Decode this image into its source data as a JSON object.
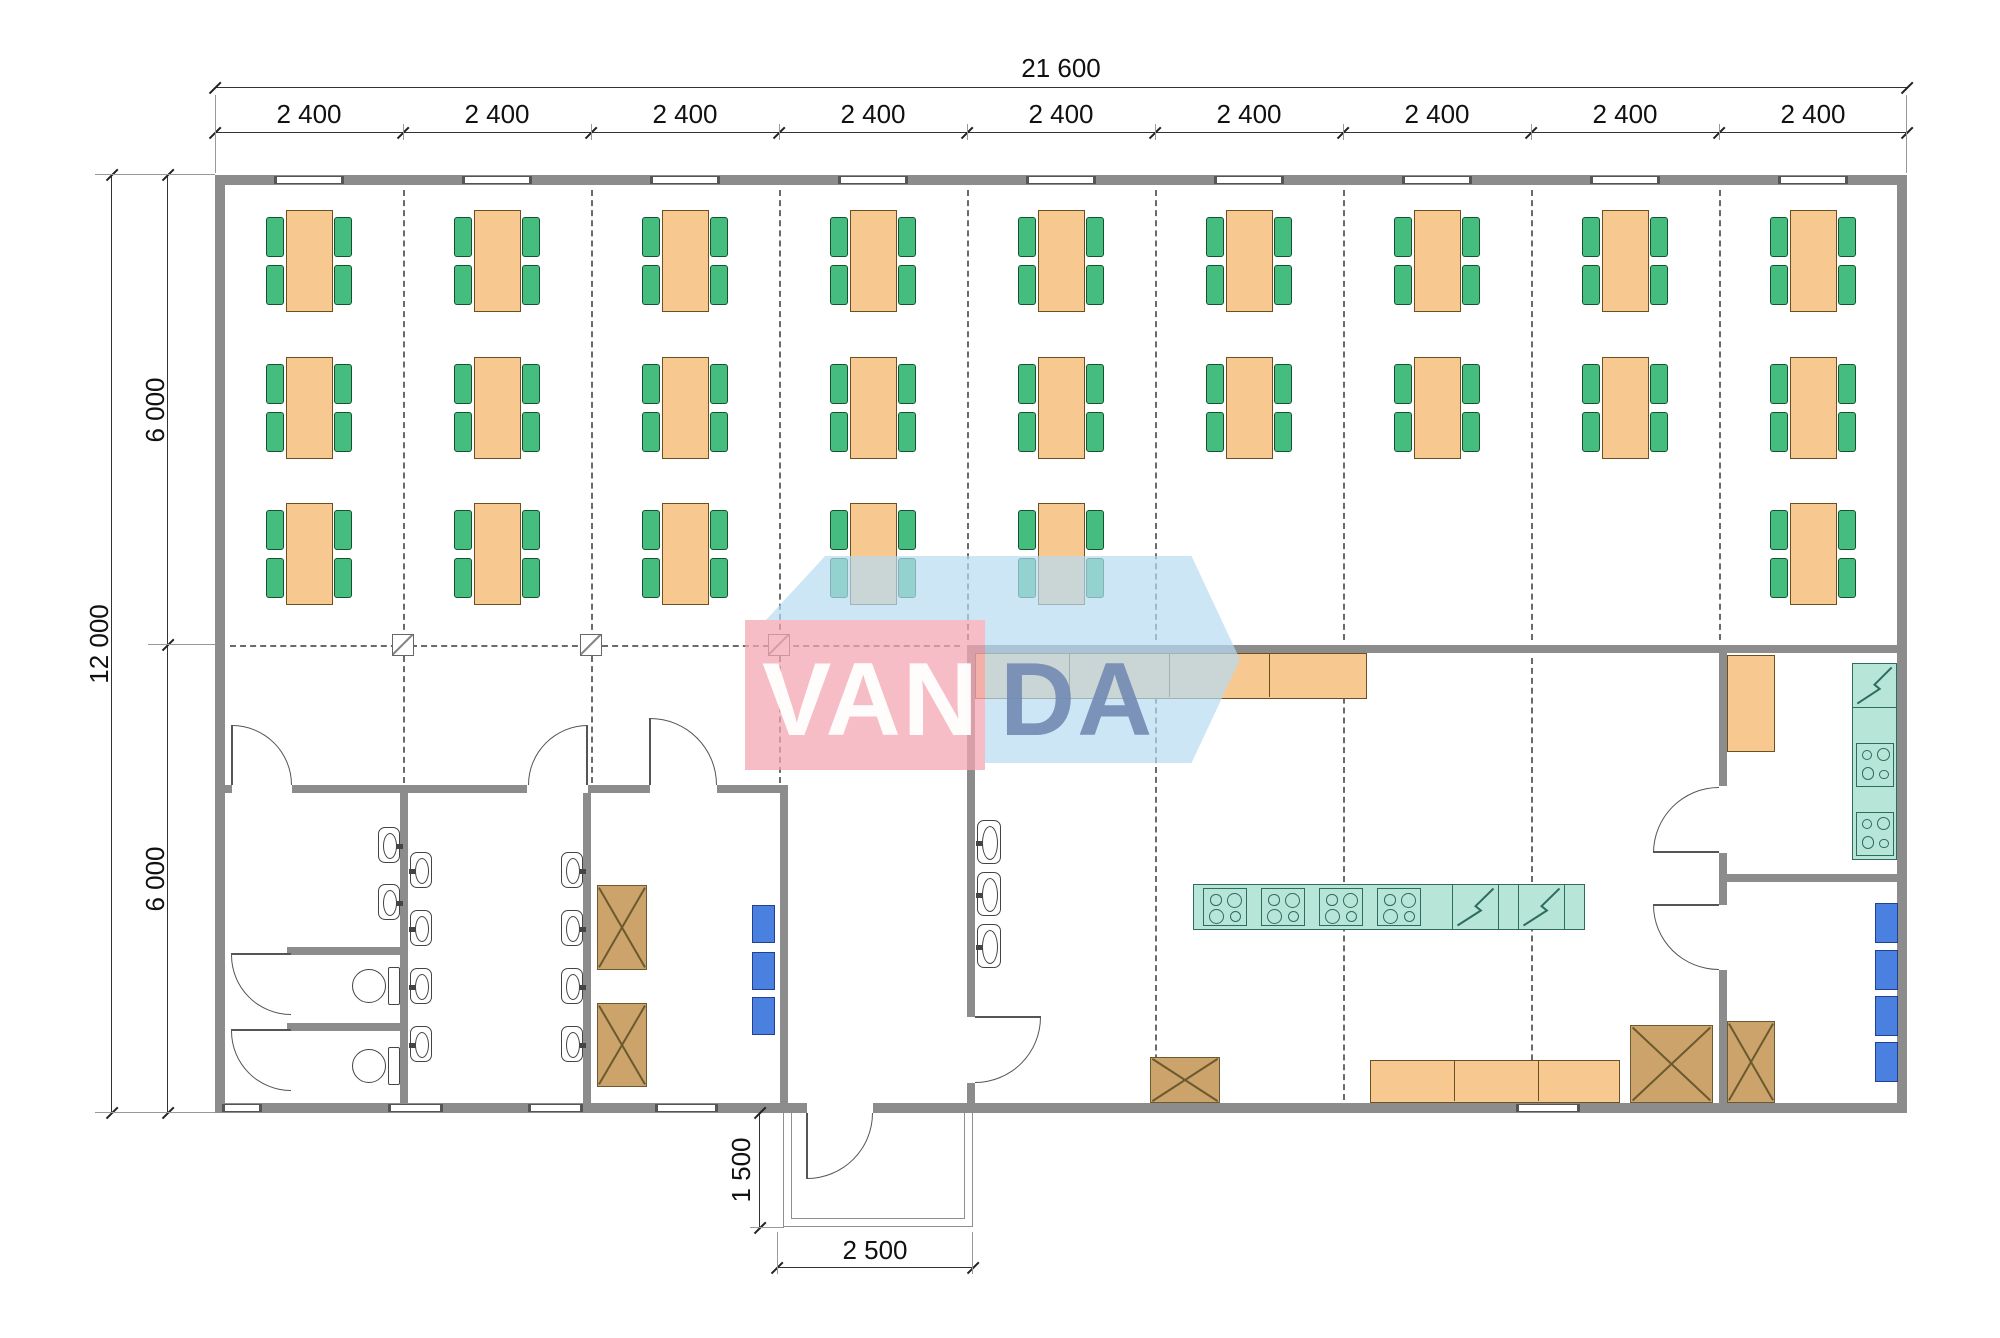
{
  "dimensions": {
    "top_total": "21 600",
    "bays": [
      "2 400",
      "2 400",
      "2 400",
      "2 400",
      "2 400",
      "2 400",
      "2 400",
      "2 400",
      "2 400"
    ],
    "left_total": "12 000",
    "left_halves": [
      "6 000",
      "6 000"
    ],
    "porch_depth": "1 500",
    "porch_width": "2 500"
  },
  "watermark": {
    "text_left": "VAN",
    "text_right": "DA",
    "pink": "#f4a6b2",
    "blue": "#b7dbf2",
    "da_color": "#7088b0"
  },
  "colors": {
    "wall": "#8c8c8c",
    "table": "#f7c890",
    "chair": "#45bd7e",
    "equipment_teal": "#b7e6d9",
    "locker_blue": "#4a80e0",
    "cabinet_brown": "#cba36b",
    "counter_orange": "#f7c890"
  },
  "plan": {
    "walls": [
      [
        215,
        175,
        1692,
        10
      ],
      [
        215,
        1103,
        592,
        10
      ],
      [
        873,
        1103,
        1034,
        10
      ],
      [
        215,
        175,
        10,
        938
      ],
      [
        1897,
        175,
        10,
        938
      ],
      [
        225,
        785,
        7,
        8
      ],
      [
        292,
        785,
        235,
        8
      ],
      [
        588,
        785,
        62,
        8
      ],
      [
        717,
        785,
        71,
        8
      ],
      [
        400,
        793,
        8,
        310
      ],
      [
        583,
        793,
        8,
        310
      ],
      [
        780,
        793,
        8,
        310
      ],
      [
        967,
        645,
        8,
        372
      ],
      [
        967,
        1083,
        8,
        20
      ],
      [
        975,
        645,
        922,
        8
      ],
      [
        287,
        947,
        113,
        8
      ],
      [
        287,
        1023,
        113,
        8
      ],
      [
        1727,
        874,
        170,
        8
      ],
      [
        1719,
        653,
        8,
        133
      ],
      [
        1719,
        853,
        8,
        52
      ],
      [
        1719,
        970,
        8,
        133
      ]
    ],
    "windows_top": [
      [
        274,
        70
      ],
      [
        462,
        70
      ],
      [
        650,
        70
      ],
      [
        838,
        70
      ],
      [
        1026,
        70
      ],
      [
        1214,
        70
      ],
      [
        1402,
        70
      ],
      [
        1590,
        70
      ],
      [
        1778,
        70
      ]
    ],
    "windows_bottom": [
      [
        222,
        40
      ],
      [
        388,
        55
      ],
      [
        528,
        55
      ],
      [
        655,
        63
      ],
      [
        1516,
        64
      ]
    ],
    "grid_v": [
      [
        403,
        190,
        640
      ],
      [
        591,
        190,
        640
      ],
      [
        779,
        190,
        640
      ],
      [
        967,
        190,
        640
      ],
      [
        1155,
        190,
        640
      ],
      [
        1343,
        190,
        640
      ],
      [
        1531,
        190,
        640
      ],
      [
        1719,
        190,
        640
      ],
      [
        403,
        656,
        783
      ],
      [
        591,
        656,
        783
      ],
      [
        779,
        656,
        783
      ],
      [
        1155,
        658,
        1100
      ],
      [
        1343,
        658,
        1100
      ],
      [
        1531,
        658,
        1100
      ]
    ],
    "grid_h": [
      [
        645,
        230,
        960
      ]
    ],
    "markers": [
      [
        392,
        634
      ],
      [
        580,
        634
      ],
      [
        768,
        634
      ]
    ],
    "bay_centers": [
      309,
      497,
      685,
      873,
      1061,
      1249,
      1437,
      1625,
      1813
    ],
    "table_rows": [
      {
        "y": 210,
        "bays": [
          0,
          1,
          2,
          3,
          4,
          5,
          6,
          7,
          8
        ]
      },
      {
        "y": 357,
        "bays": [
          0,
          1,
          2,
          3,
          4,
          5,
          6,
          7,
          8
        ]
      },
      {
        "y": 503,
        "bays": [
          0,
          1,
          2,
          3,
          4,
          8
        ]
      }
    ],
    "basins": [
      [
        378,
        827,
        22,
        36,
        "e"
      ],
      [
        378,
        884,
        22,
        36,
        "e"
      ],
      [
        410,
        852,
        22,
        36,
        "w"
      ],
      [
        410,
        910,
        22,
        36,
        "w"
      ],
      [
        410,
        968,
        22,
        36,
        "w"
      ],
      [
        410,
        1026,
        22,
        36,
        "w"
      ],
      [
        561,
        852,
        22,
        36,
        "e"
      ],
      [
        561,
        910,
        22,
        36,
        "e"
      ],
      [
        561,
        968,
        22,
        36,
        "e"
      ],
      [
        561,
        1026,
        22,
        36,
        "e"
      ],
      [
        977,
        820,
        24,
        44,
        "w"
      ],
      [
        977,
        872,
        24,
        44,
        "w"
      ],
      [
        977,
        924,
        24,
        44,
        "w"
      ]
    ],
    "toilets": [
      [
        352,
        966
      ],
      [
        352,
        1046
      ]
    ],
    "x_cabinets": [
      [
        597,
        885,
        50,
        85
      ],
      [
        597,
        1003,
        50,
        84
      ],
      [
        1150,
        1057,
        70,
        46
      ],
      [
        1630,
        1025,
        83,
        78
      ],
      [
        1727,
        1021,
        48,
        82
      ]
    ],
    "lockers": [
      [
        752,
        905,
        23,
        38
      ],
      [
        752,
        952,
        23,
        38
      ],
      [
        752,
        997,
        23,
        38
      ],
      [
        1875,
        903,
        23,
        40
      ],
      [
        1875,
        950,
        23,
        40
      ],
      [
        1875,
        996,
        23,
        40
      ],
      [
        1875,
        1042,
        23,
        40
      ]
    ],
    "counters": [
      {
        "x": 975,
        "y": 653,
        "w": 392,
        "h": 46,
        "divs": [
          93,
          193,
          293
        ],
        "name": "serving-counter"
      },
      {
        "x": 1370,
        "y": 1060,
        "w": 250,
        "h": 43,
        "divs": [
          83,
          167
        ],
        "name": "kitchen-counter"
      },
      {
        "x": 1727,
        "y": 655,
        "w": 48,
        "h": 97,
        "divs": [],
        "name": "kitchen-cabinet"
      }
    ],
    "teal_counters": [
      [
        1852,
        663,
        45,
        197
      ],
      [
        1193,
        884,
        392,
        46
      ]
    ],
    "stoves": [
      [
        1203,
        888,
        44,
        38
      ],
      [
        1261,
        888,
        44,
        38
      ],
      [
        1319,
        888,
        44,
        38
      ],
      [
        1377,
        888,
        44,
        38
      ],
      [
        1856,
        743,
        38,
        44
      ],
      [
        1856,
        812,
        38,
        44
      ]
    ],
    "diag_cells": [
      [
        1452,
        884,
        47,
        46
      ],
      [
        1518,
        884,
        47,
        46
      ],
      [
        1852,
        663,
        45,
        45
      ]
    ],
    "arcs": [
      [
        232,
        725,
        60,
        60,
        "tr"
      ],
      [
        528,
        725,
        60,
        60,
        "tl"
      ],
      [
        650,
        718,
        67,
        67,
        "tr"
      ],
      [
        975,
        1017,
        66,
        66,
        "br"
      ],
      [
        807,
        1113,
        66,
        66,
        "br"
      ],
      [
        1653,
        787,
        66,
        66,
        "tl"
      ],
      [
        1653,
        905,
        66,
        65,
        "bl"
      ],
      [
        231,
        955,
        60,
        60,
        "bl"
      ],
      [
        231,
        1031,
        60,
        60,
        "bl"
      ]
    ],
    "leaves": [
      [
        231,
        725,
        2,
        60
      ],
      [
        586,
        725,
        2,
        60
      ],
      [
        649,
        718,
        2,
        67
      ],
      [
        975,
        1016,
        66,
        2
      ],
      [
        806,
        1113,
        2,
        66
      ],
      [
        1653,
        851,
        66,
        2
      ],
      [
        1653,
        904,
        66,
        2
      ],
      [
        231,
        953,
        60,
        2
      ],
      [
        231,
        1029,
        60,
        2
      ]
    ],
    "porch": {
      "outer": [
        783,
        1113,
        190,
        114
      ],
      "inner": [
        791,
        1113,
        174,
        106
      ]
    },
    "dim_lines": [
      [
        215,
        87,
        1692,
        1
      ],
      [
        215,
        132,
        1692,
        1
      ],
      [
        111,
        175,
        1,
        938
      ],
      [
        167,
        175,
        1,
        938
      ],
      [
        759,
        1113,
        1,
        115
      ],
      [
        777,
        1267,
        196,
        1
      ]
    ],
    "ticks": [
      [
        215,
        88
      ],
      [
        1907,
        88
      ],
      [
        215,
        133
      ],
      [
        403,
        133
      ],
      [
        591,
        133
      ],
      [
        779,
        133
      ],
      [
        967,
        133
      ],
      [
        1155,
        133
      ],
      [
        1343,
        133
      ],
      [
        1531,
        133
      ],
      [
        1719,
        133
      ],
      [
        1907,
        133
      ],
      [
        112,
        175
      ],
      [
        112,
        1113
      ],
      [
        168,
        175
      ],
      [
        168,
        645
      ],
      [
        168,
        1113
      ],
      [
        760,
        1113
      ],
      [
        760,
        1228
      ],
      [
        777,
        1268
      ],
      [
        973,
        1268
      ]
    ],
    "exts": [
      [
        215,
        95,
        1,
        78
      ],
      [
        1906,
        95,
        1,
        78
      ],
      [
        95,
        174,
        120,
        1
      ],
      [
        95,
        1112,
        120,
        1
      ],
      [
        148,
        644,
        67,
        1
      ],
      [
        750,
        1227,
        34,
        1
      ],
      [
        777,
        1232,
        1,
        42
      ],
      [
        972,
        1232,
        1,
        42
      ],
      [
        403,
        124,
        1,
        16
      ],
      [
        591,
        124,
        1,
        16
      ],
      [
        779,
        124,
        1,
        16
      ],
      [
        967,
        124,
        1,
        16
      ],
      [
        1155,
        124,
        1,
        16
      ],
      [
        1343,
        124,
        1,
        16
      ],
      [
        1531,
        124,
        1,
        16
      ],
      [
        1719,
        124,
        1,
        16
      ]
    ],
    "bay_label_y": 101,
    "labels": [
      {
        "x": 1011,
        "y": 55,
        "w": 100,
        "bind": "dimensions.top_total",
        "rot": false,
        "name": "dim-total-width"
      },
      {
        "x": 54,
        "y": 631,
        "w": 90,
        "bind": "dimensions.left_total",
        "rot": true,
        "name": "dim-total-height"
      },
      {
        "x": 110,
        "y": 397,
        "w": 90,
        "bind": "dimensions.left_halves.0",
        "rot": true,
        "name": "dim-half-height-top"
      },
      {
        "x": 110,
        "y": 866,
        "w": 90,
        "bind": "dimensions.left_halves.1",
        "rot": true,
        "name": "dim-half-height-bottom"
      },
      {
        "x": 696,
        "y": 1157,
        "w": 90,
        "bind": "dimensions.porch_depth",
        "rot": true,
        "name": "dim-porch-depth"
      },
      {
        "x": 830,
        "y": 1237,
        "w": 90,
        "bind": "dimensions.porch_width",
        "rot": false,
        "name": "dim-porch-width"
      }
    ]
  }
}
